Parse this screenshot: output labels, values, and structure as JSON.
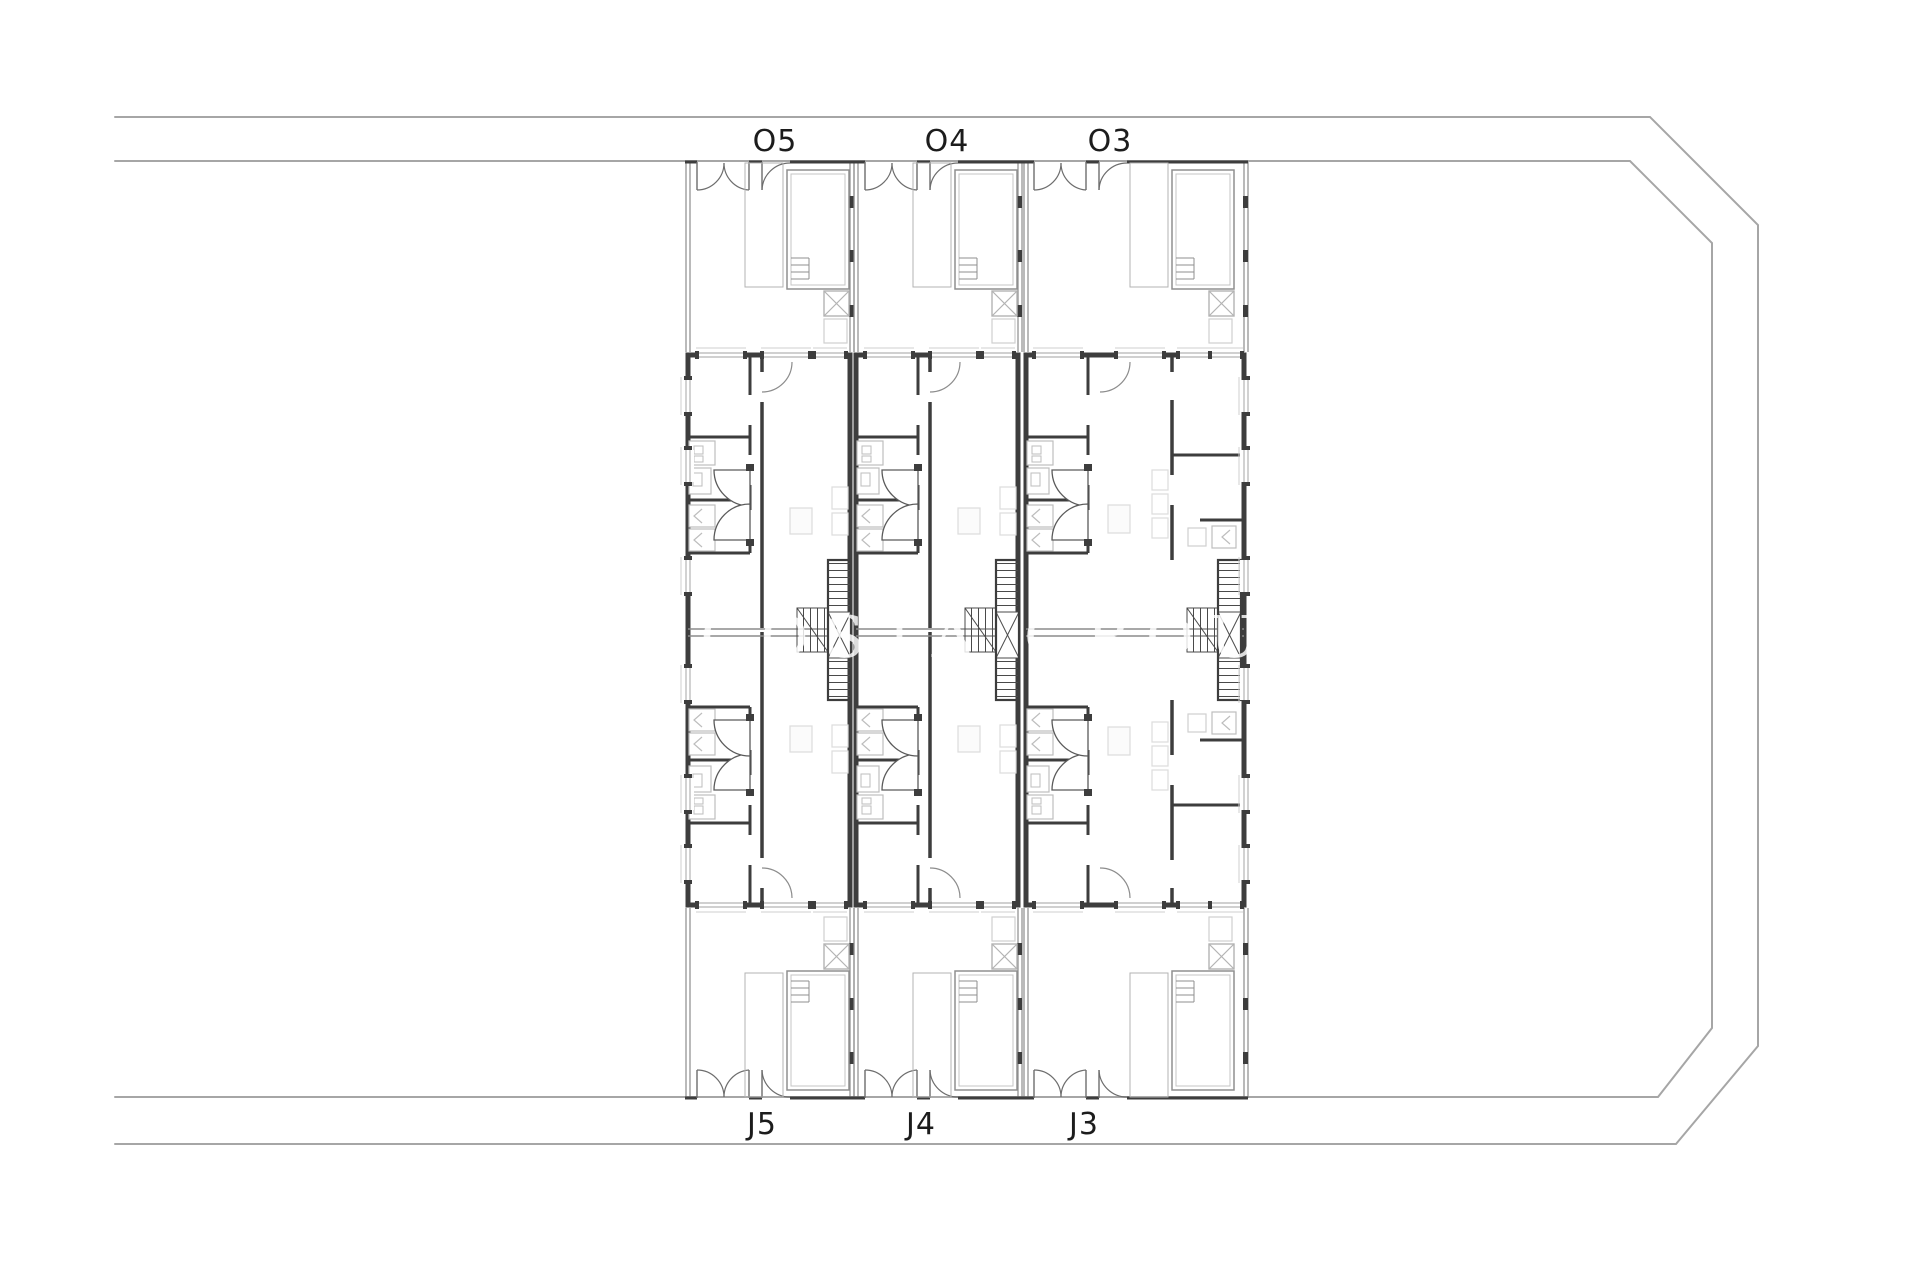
{
  "document": {
    "type": "architectural-site-floor-plan",
    "background": "#ffffff"
  },
  "units": {
    "top_row": [
      {
        "label": "O5"
      },
      {
        "label": "O4"
      },
      {
        "label": "O3"
      }
    ],
    "bottom_row": [
      {
        "label": "J5"
      },
      {
        "label": "J4"
      },
      {
        "label": "J3"
      }
    ]
  },
  "watermark": {
    "text": "COSTA GROUP"
  },
  "colors": {
    "wall": "#3d3d3d",
    "thin_line": "#b3b3b3",
    "road_line": "#a6a6a6",
    "yard_wall": "#8c8c8c",
    "stair_line": "#4a4a4a",
    "fixture_line": "#bdbdbd",
    "furniture_line": "#dcdcdc",
    "label_text": "#1c1c1c"
  }
}
